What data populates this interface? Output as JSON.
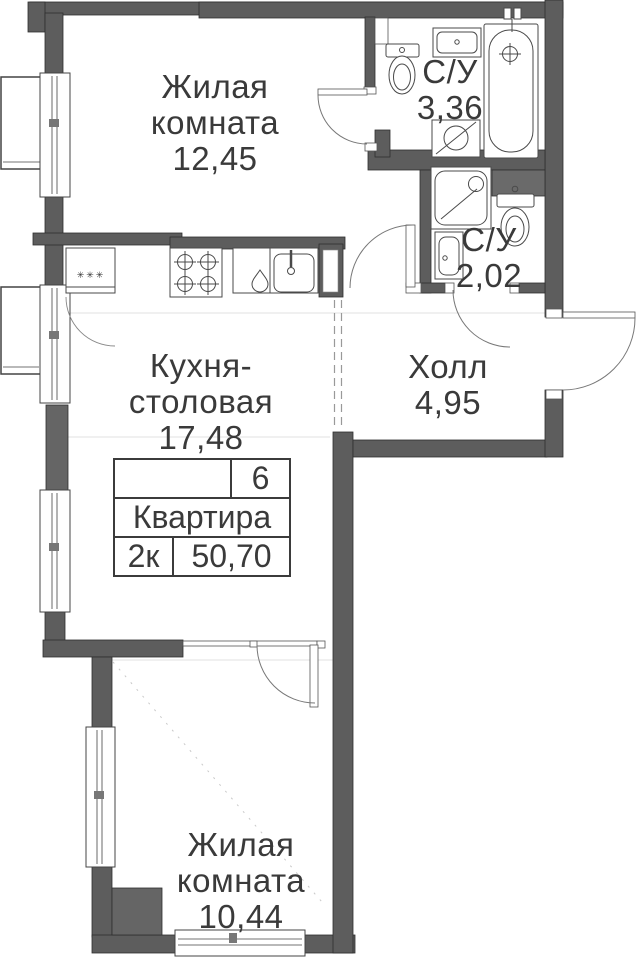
{
  "labels": {
    "living1": {
      "line1": "Жилая",
      "line2": "комната",
      "area": "12,45"
    },
    "bath1": {
      "name": "С/У",
      "area": "3,36"
    },
    "bath2": {
      "name": "С/У",
      "area": "2,02"
    },
    "kitchen": {
      "line1": "Кухня-",
      "line2": "столовая",
      "area": "17,48"
    },
    "hall": {
      "name": "Холл",
      "area": "4,95"
    },
    "living2": {
      "line1": "Жилая",
      "line2": "комната",
      "area": "10,44"
    }
  },
  "info_table": {
    "flat_number": "6",
    "flat_label": "Квартира",
    "rooms_count": "2к",
    "total_area": "50,70"
  },
  "fridge_marks": "✳✳✳",
  "colors": {
    "wall": "#5d5d5d",
    "wall_outline": "#2f2f2f",
    "line": "#4a4a4a",
    "text": "#3a3a3a"
  }
}
